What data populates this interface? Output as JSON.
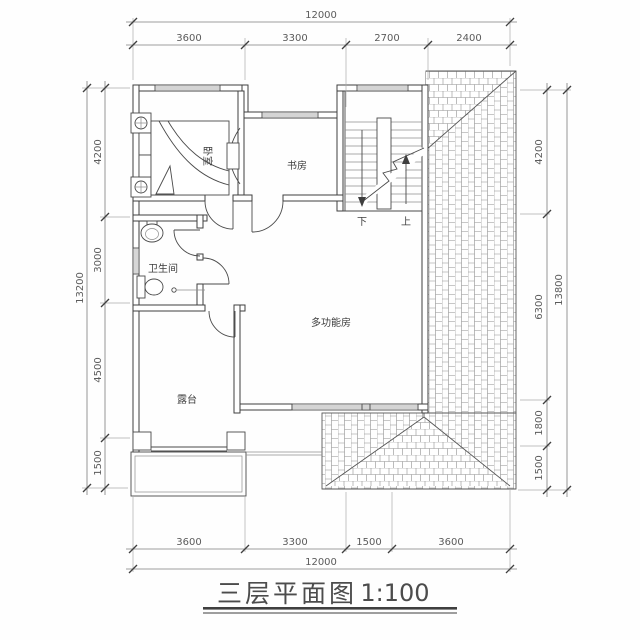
{
  "title": {
    "name": "三层平面图",
    "scale": "1:100"
  },
  "rooms": {
    "bedroom": "卧室",
    "study": "书房",
    "bathroom": "卫生间",
    "multifunction": "多功能房",
    "terrace": "露台"
  },
  "stairs": {
    "down": "下",
    "up": "上"
  },
  "dimensions": {
    "top": {
      "total": "12000",
      "segments": [
        "3600",
        "3300",
        "2700",
        "2400"
      ]
    },
    "bottom": {
      "total": "12000",
      "segments": [
        "3600",
        "3300",
        "1500",
        "3600"
      ]
    },
    "left": {
      "total": "13200",
      "segments": [
        "4200",
        "3000",
        "4500",
        "1500"
      ]
    },
    "right": {
      "total": "13800",
      "segments": [
        "4200",
        "6300",
        "1800",
        "1500"
      ]
    }
  },
  "colors": {
    "line": "#3f3f3f",
    "dim": "#5b5b5b",
    "tile": "#8f8f8f",
    "background": "#fefefe"
  }
}
